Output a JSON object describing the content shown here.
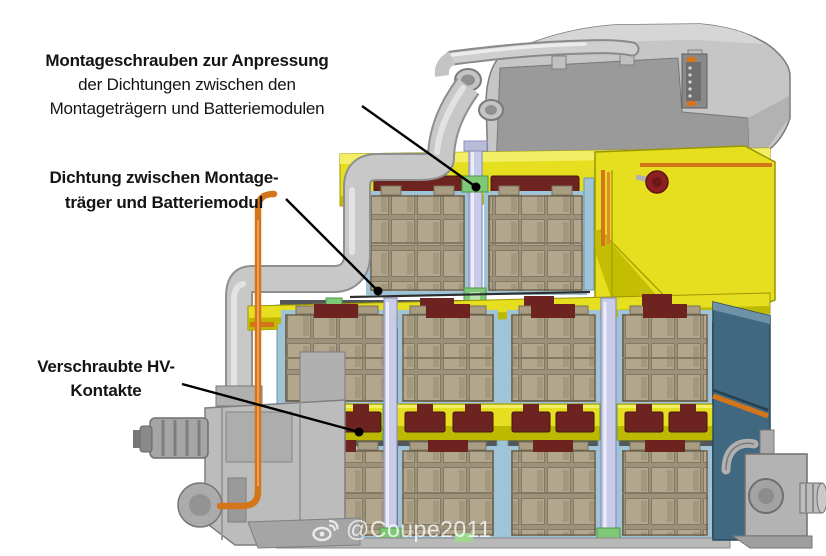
{
  "annotations": {
    "montageschrauben": {
      "line1": "Montageschrauben zur Anpressung",
      "line2": "der Dichtungen zwischen den",
      "line3": "Montageträgern und Batteriemodulen"
    },
    "dichtung": {
      "line1": "Dichtung zwischen Montage-",
      "line2": "träger und Batteriemodul"
    },
    "hv_kontakte": {
      "line1": "Verschraubte HV-",
      "line2": "Kontakte"
    }
  },
  "watermark": {
    "icon": "weibo-icon",
    "text": "@Coupe2011"
  },
  "colors": {
    "frame_yellow": "#e5df20",
    "frame_yellow_light": "#f2ee66",
    "frame_yellow_dark": "#bdb800",
    "gasket_maroon": "#6d2420",
    "module_tan": "#b2a68d",
    "side_panel_blue": "#406880",
    "screw_lavender": "#c9cce9",
    "trim_green": "#7fc877",
    "trim_green_light": "#b9e4ae",
    "trim_blue": "#9fc4d8",
    "cable_orange": "#d4751c",
    "port_red": "#8c1f1f",
    "housing_gray": "#c6c6c6"
  }
}
